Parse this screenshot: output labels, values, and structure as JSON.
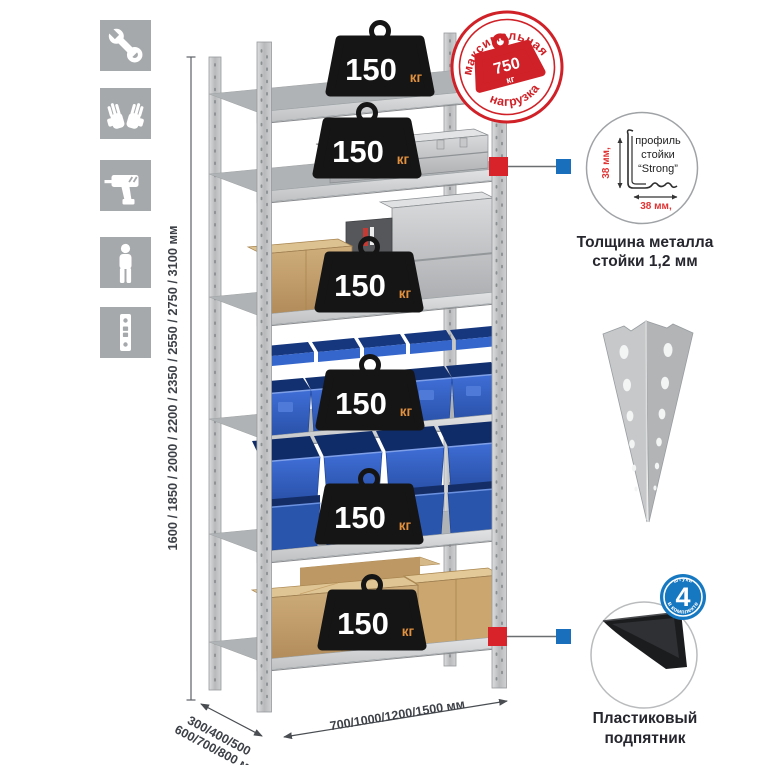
{
  "dimensions": {
    "height_label": "1600 / 1850 / 2000 / 2200 / 2350 / 2550 / 2750 / 3100 мм",
    "depth_line1": "300/400/500",
    "depth_line2": "600/700/800 мм",
    "width_label": "700/1000/1200/1500 мм"
  },
  "stamp": {
    "arc_top": "максимальная",
    "arc_bottom": "нагрузка",
    "value": "750",
    "unit": "кг"
  },
  "shelf_badge": {
    "value": "150",
    "unit": "кг"
  },
  "profile_detail": {
    "label_line1": "профиль",
    "label_line2": "стойки",
    "label_line3": "“Strong”",
    "dim_vertical": "38 мм,",
    "dim_horizontal": "38 мм,",
    "caption_line1": "Толщина металла",
    "caption_line2": "стойки 1,2 мм"
  },
  "foot_detail": {
    "badge_value": "4",
    "badge_arc_top": "штуки",
    "badge_arc_bottom": "в комплекте",
    "caption_line1": "Пластиковый",
    "caption_line2": "подпятник"
  },
  "sidebar_icons": [
    "wrench-icon",
    "gloves-icon",
    "drill-icon",
    "person-icon",
    "profile-strip-icon"
  ],
  "colors": {
    "stamp_red": "#cf2127",
    "marker_red": "#d8232a",
    "marker_blue": "#1a6fbd",
    "bin_blue": "#2e5fc2",
    "icon_gray": "#a6a9ab",
    "metal_gray": "#c3c5c7",
    "badge_black": "#151515",
    "badge_unit_orange": "#e2913d",
    "cardboard": "#c29c68",
    "dim_text": "#3d4147"
  }
}
